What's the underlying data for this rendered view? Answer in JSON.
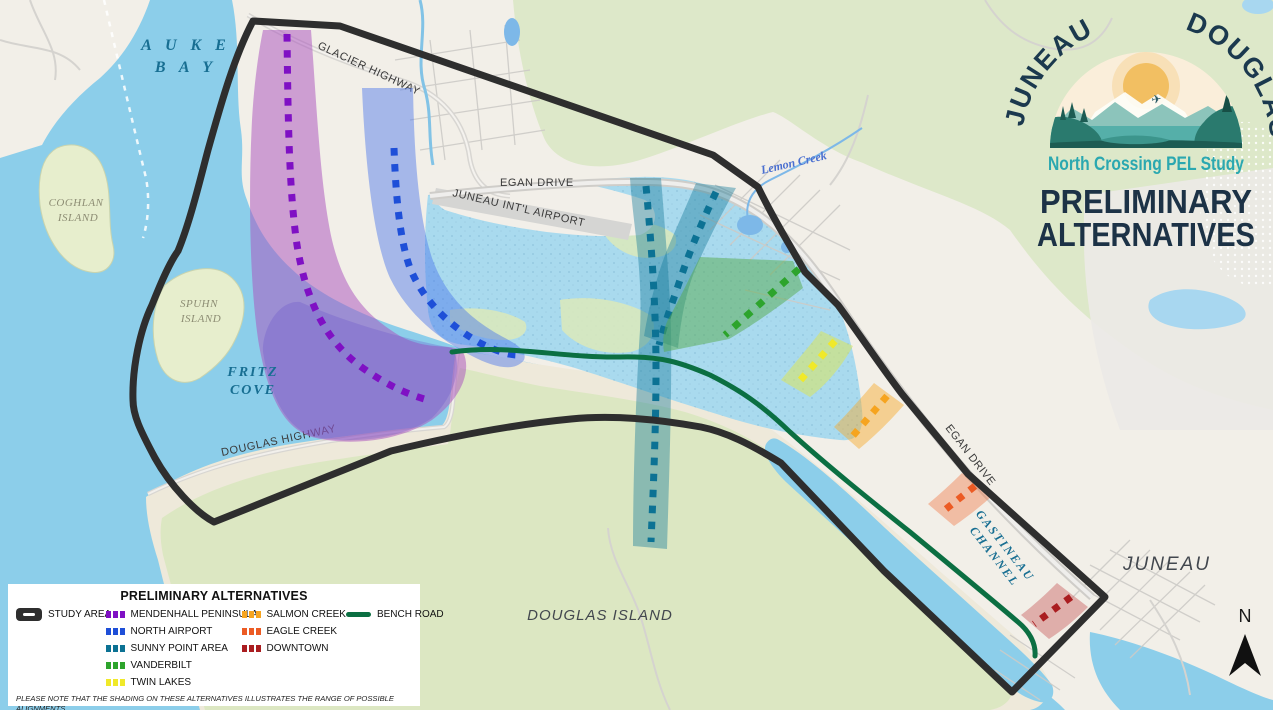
{
  "logo": {
    "arc_left": "JUNEAU",
    "arc_right": "DOUGLAS",
    "subtitle": "North Crossing PEL Study",
    "heading_line1": "PRELIMINARY",
    "heading_line2": "ALTERNATIVES",
    "heading_color": "#1c3246",
    "subtitle_color": "#2ba8b0"
  },
  "map": {
    "labels": {
      "auke_bay_1": "A U K E",
      "auke_bay_2": "B A Y",
      "coghlan_1": "COGHLAN",
      "coghlan_2": "ISLAND",
      "spuhn_1": "SPUHN",
      "spuhn_2": "ISLAND",
      "fritz_1": "FRITZ",
      "fritz_2": "COVE",
      "glacier_highway": "GLACIER HIGHWAY",
      "egan_drive_north": "EGAN DRIVE",
      "egan_drive_south": "EGAN DRIVE",
      "juneau_airport": "JUNEAU INT'L AIRPORT",
      "lemon_creek": "Lemon Creek",
      "douglas_highway": "DOUGLAS HIGHWAY",
      "douglas_island": "DOUGLAS ISLAND",
      "gastineau_1": "GASTINEAU",
      "gastineau_2": "CHANNEL",
      "juneau_city": "JUNEAU",
      "compass_n": "N"
    }
  },
  "legend": {
    "title": "PRELIMINARY ALTERNATIVES",
    "study_area": {
      "label": "STUDY AREA",
      "color": "#2e2e2e"
    },
    "alternatives": [
      {
        "label": "MENDENHALL PENINSULA",
        "color": "#7f10c4"
      },
      {
        "label": "NORTH AIRPORT",
        "color": "#1e4fd8"
      },
      {
        "label": "SUNNY POINT AREA",
        "color": "#0c7294"
      },
      {
        "label": "VANDERBILT",
        "color": "#2da42c"
      },
      {
        "label": "TWIN LAKES",
        "color": "#f0e929"
      },
      {
        "label": "SALMON CREEK",
        "color": "#f6a41f"
      },
      {
        "label": "EAGLE CREEK",
        "color": "#ec5b24"
      },
      {
        "label": "DOWNTOWN",
        "color": "#aa1d20"
      }
    ],
    "bench_road": {
      "label": "BENCH ROAD",
      "color": "#0b6f42"
    },
    "footnote_line1": "PLEASE NOTE THAT THE SHADING ON THESE ALTERNATIVES ILLUSTRATES THE RANGE OF POSSIBLE ALIGNMENTS",
    "footnote_line2": "AND TERMINI FOR EACH RATHER THAN THE ANTICIPATED FOOTPRINT."
  }
}
